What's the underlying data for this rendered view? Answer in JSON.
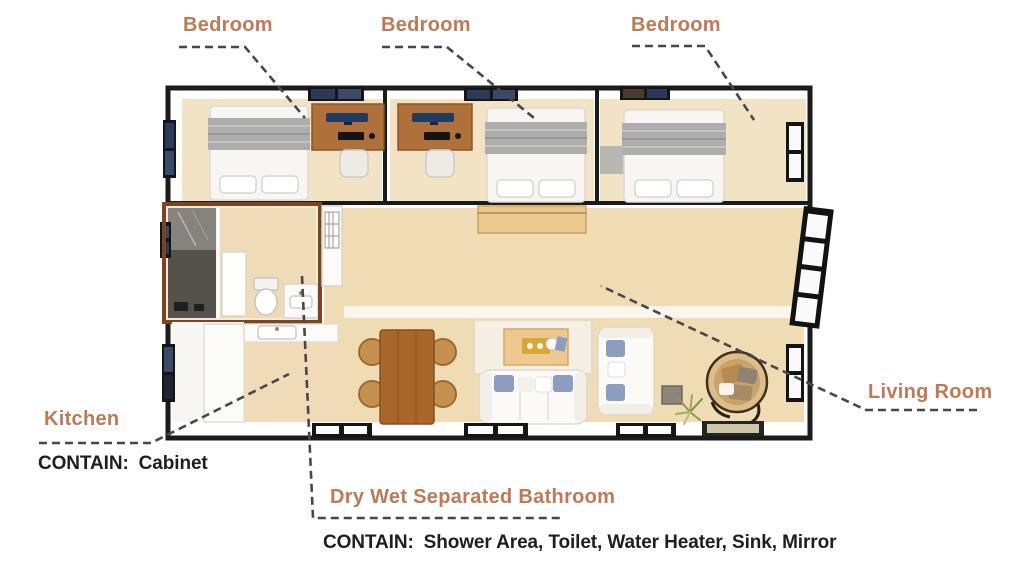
{
  "colors": {
    "label": "#BE7A55",
    "contain": "#1e1e20",
    "leader": "#474747",
    "wall": "#1b1b1b",
    "bathroom_wall": "#7A4520",
    "floor_bedroom": "#F2E3C4",
    "floor_main": "#F0DCB4",
    "wood_desk": "#B0703A",
    "wood_table": "#A9662A"
  },
  "annotations": {
    "bedroom_1": {
      "label": "Bedroom"
    },
    "bedroom_2": {
      "label": "Bedroom"
    },
    "bedroom_3": {
      "label": "Bedroom"
    },
    "kitchen": {
      "label": "Kitchen",
      "contain_prefix": "CONTAIN:",
      "contain_items": "Cabinet"
    },
    "bathroom": {
      "label": "Dry Wet Separated Bathroom",
      "contain_prefix": "CONTAIN:",
      "contain_items": "Shower Area, Toilet, Water Heater, Sink, Mirror"
    },
    "living_room": {
      "label": "Living Room"
    }
  }
}
